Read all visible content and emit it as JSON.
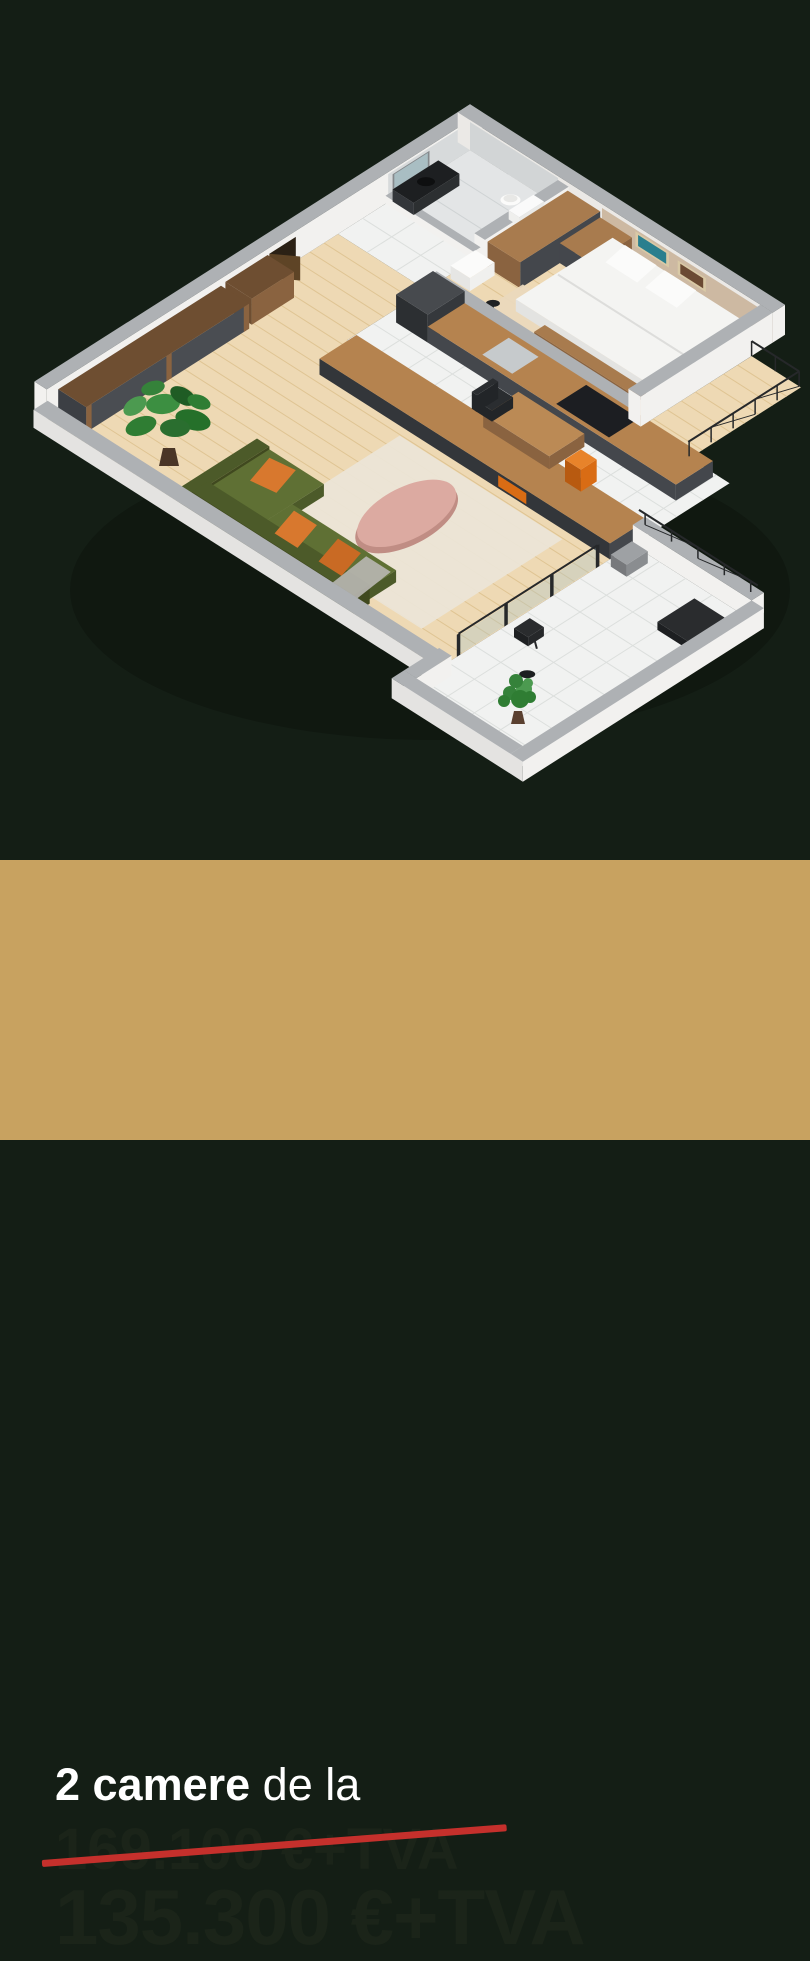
{
  "card": {
    "title_bold": "2 camere",
    "title_rest": " de la",
    "old_price": "169.100 €+TVA",
    "new_price": "135.300 €+TVA"
  },
  "colors": {
    "background": "#141e15",
    "band": "#c8a260",
    "title_text": "#ffffff",
    "price_text": "#1b2419",
    "strike_line": "#c5302c"
  },
  "floor_plan_palette": {
    "wall_face": "#f2f1ef",
    "wall_face_shaded": "#ebe9e6",
    "wall_cap": "#aeb1b4",
    "wall_outer": "#dddcda",
    "floor_wood": "#eed9b4",
    "floor_wood_line": "#dfc493",
    "floor_tile": "#f1f2f1",
    "floor_tile_line": "#dcdfdd",
    "floor_marble": "#e3e5e6",
    "marble_wall": "#d7dadb",
    "wood_dark": "#8a6340",
    "wood_mid": "#a87b4e",
    "counter_top": "#b5834f",
    "cabinet_dark": "#44474c",
    "cabinet_darker": "#33363a",
    "sofa_green": "#5f7034",
    "sofa_green_dark": "#4c5a29",
    "pillow_orange": "#d8782e",
    "table_pink": "#dcaaa1",
    "table_pink_dark": "#c08d84",
    "bed_white": "#f4f4f2",
    "bed_side": "#e3e3e1",
    "headboard": "#cdb9a2",
    "art_teal": "#2a7f8e",
    "art_brown": "#6b4a33",
    "plant_green": "#2f7d33",
    "plant_green_dark": "#1f5c24",
    "plant_green_light": "#4c9a50",
    "metal_dark": "#26282a",
    "rug": "#ebe5d8",
    "glass": "#aac7cc",
    "fire_orange": "#d96c14"
  }
}
